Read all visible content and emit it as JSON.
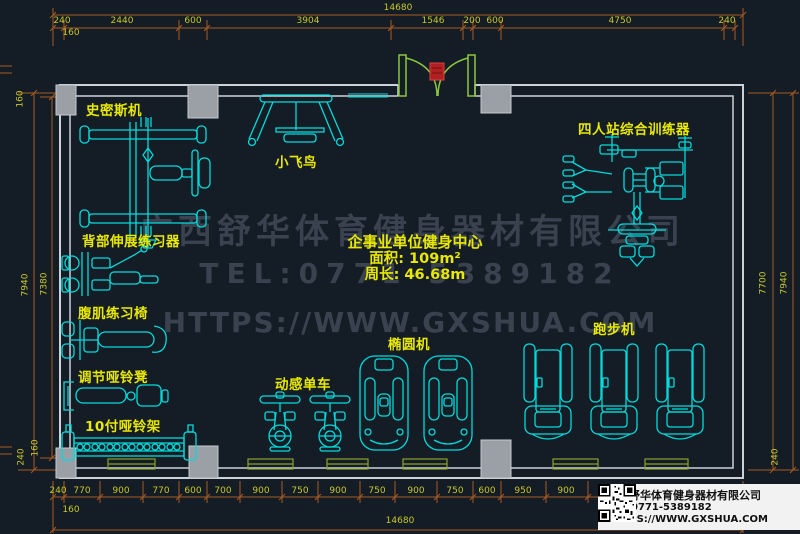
{
  "plan": {
    "labels": {
      "smith": "史密斯机",
      "back_extension": "背部伸展练习器",
      "ab_chair": "腹肌练习椅",
      "dumbbell_bench": "调节哑铃凳",
      "dumbbell_rack": "10付哑铃架",
      "fly_bird": "小飞鸟",
      "four_station": "四人站综合训练器",
      "spin_bike": "动感单车",
      "elliptical": "椭圆机",
      "treadmill": "跑步机"
    },
    "center_info": {
      "title": "企事业单位健身中心",
      "area": "面积: 109m²",
      "perimeter": "周长: 46.68m"
    },
    "watermark": {
      "company": "广西舒华体育健身器材有限公司",
      "tel": "TEL:0771-5389182",
      "url": "HTTPS://WWW.GXSHUA.COM"
    },
    "info_box": {
      "company": "广西舒华体育健身器材有限公司",
      "tel": "TEL:0771-5389182",
      "url": "HTTPS://WWW.GXSHUA.COM"
    },
    "dimensions": {
      "top_total": "14680",
      "top_segments": [
        "240",
        "2440",
        "600",
        "3904",
        "1546",
        "200",
        "600",
        "4750",
        "240"
      ],
      "top_offset": "160",
      "bottom_segments": [
        "240",
        "770",
        "900",
        "770",
        "600",
        "700",
        "900",
        "750",
        "900",
        "750",
        "900",
        "750",
        "600",
        "950",
        "900"
      ],
      "bottom_offset": "160",
      "bottom_total": "14680",
      "left": {
        "outer": "7940",
        "inner": "7380",
        "top": "160",
        "bottom_a": "240",
        "bottom_b": "160"
      },
      "right": {
        "inner": "7700",
        "outer": "7940",
        "bottom": "240"
      }
    },
    "colors": {
      "background": "#141c26",
      "equipment": "#00dcdc",
      "label": "#e8e800",
      "dimension_line": "#a85a20",
      "dimension_text": "#c8c828",
      "wall": "#cdd2d8",
      "column": "#9aa0a6",
      "window": "#8aa32a",
      "door": "#8cc63f",
      "door_marker": "#c22020",
      "watermark": "#39424e"
    }
  }
}
